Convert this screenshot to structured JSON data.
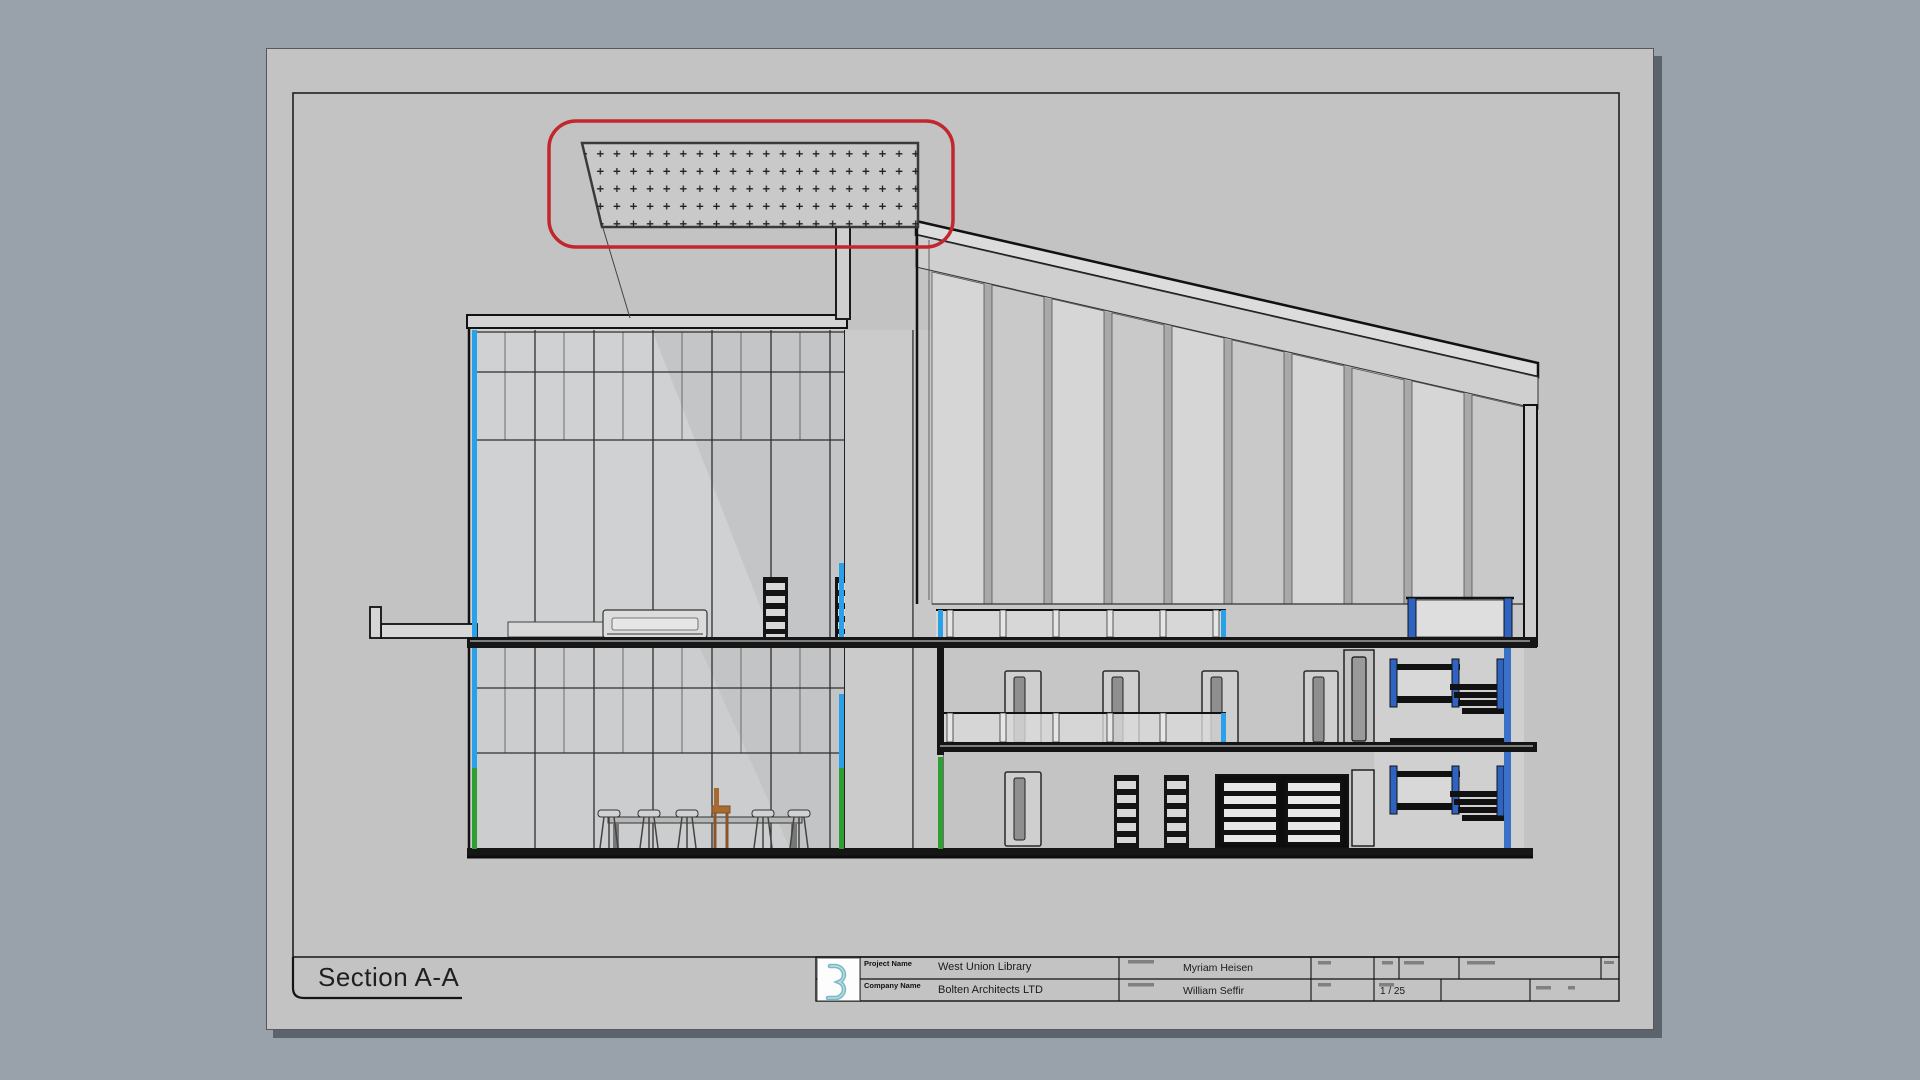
{
  "sheet": {
    "view_title": "Section A-A"
  },
  "title_block": {
    "project_name_label": "Project Name",
    "project_name": "West Union Library",
    "company_name_label": "Company Name",
    "company_name": "Bolten Architects LTD",
    "checked_by": "Myriam Heisen",
    "drawn_by": "William Seffir",
    "scale": "1 / 25"
  },
  "annotation": {
    "revision_cloud_color": "#c1272d",
    "highlighted_element": "perforated ceiling panel detail callout"
  },
  "colors": {
    "background": "#99a1aa",
    "paper": "#c3c3c3",
    "cut_line_cyan": "#2aa0e8",
    "cut_line_green": "#2f9e33",
    "stair_rail_blue": "#2f63c1",
    "stair_edge_blue": "#3a72c8",
    "revision_red": "#c1272d",
    "logo_teal": "#79b9c6"
  }
}
